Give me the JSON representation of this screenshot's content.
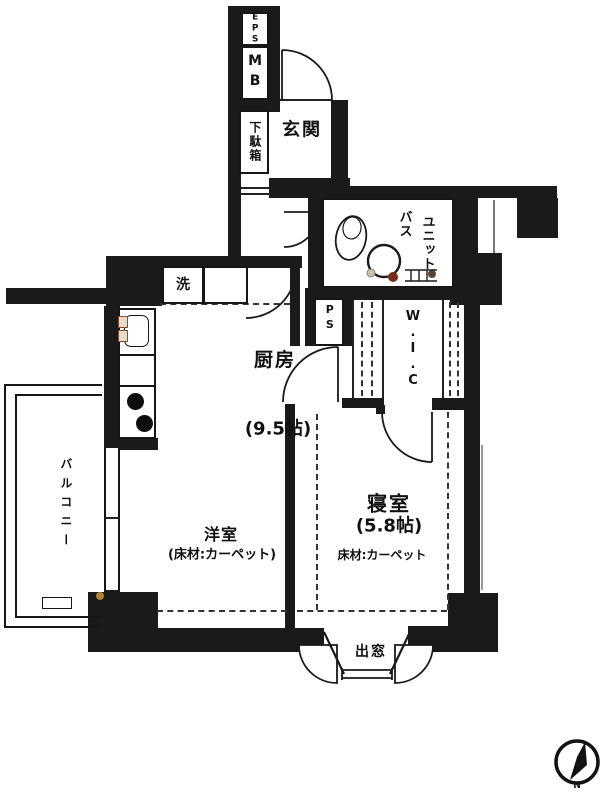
{
  "floorplan": {
    "rooms": {
      "genkan": {
        "label": "玄関"
      },
      "kitchen": {
        "label": "厨房",
        "size": "(9.5帖)"
      },
      "western_room": {
        "label": "洋室",
        "floor": "(床材:カーペット)"
      },
      "bedroom": {
        "label": "寝室",
        "size": "(5.8帖)",
        "floor": "床材:カーペット"
      },
      "balcony": {
        "label": "バルコニー"
      },
      "unit_bath": {
        "label_right_column": "ユニット",
        "label_left_column": "バス"
      },
      "wic": {
        "label": "W.I.C"
      },
      "bay_window": {
        "label": "出窓"
      }
    },
    "fixtures": {
      "shoe_cabinet": "下駄箱",
      "washer": "洗",
      "pipe_space": "PS",
      "meter_box": "MB",
      "electric_pipe_space": "EPS"
    },
    "compass": {
      "north": "N"
    },
    "colors": {
      "wall": "#1a1a1a",
      "line": "#222222",
      "accent_red": "#7b2d1d",
      "paper": "#ffffff"
    }
  }
}
